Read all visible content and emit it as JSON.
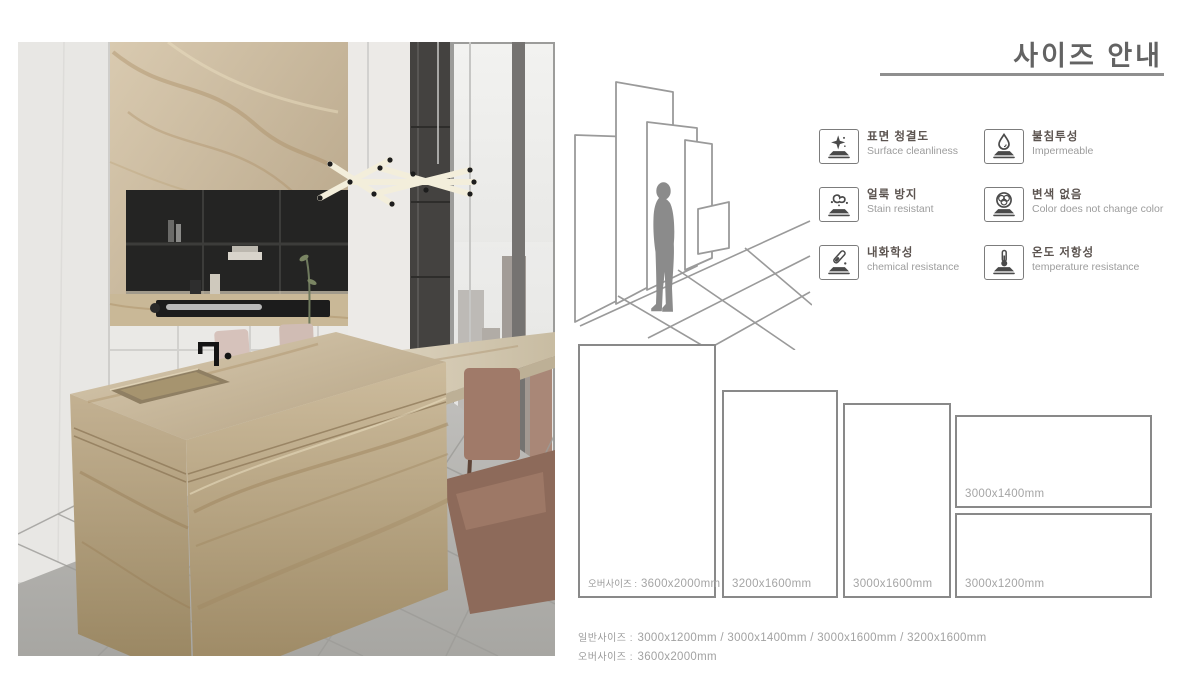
{
  "page": {
    "title": "사이즈 안내"
  },
  "features": [
    {
      "icon": "sparkle-clean-surface-icon",
      "ko": "표면 청결도",
      "en": "Surface cleanliness"
    },
    {
      "icon": "water-drop-icon",
      "ko": "불침투성",
      "en": "Impermeable"
    },
    {
      "icon": "stain-splash-icon",
      "ko": "얼룩 방지",
      "en": "Stain resistant"
    },
    {
      "icon": "color-circles-icon",
      "ko": "변색 없음",
      "en": "Color does not change color"
    },
    {
      "icon": "test-tube-icon",
      "ko": "내화학성",
      "en": "chemical resistance"
    },
    {
      "icon": "thermometer-icon",
      "ko": "온도 저항성",
      "en": "temperature resistance"
    }
  ],
  "slabs": [
    {
      "prefix": "오버사이즈 :",
      "size": "3600x2000mm"
    },
    {
      "size": "3200x1600mm"
    },
    {
      "size": "3000x1600mm"
    },
    {
      "size": "3000x1400mm"
    },
    {
      "size": "3000x1200mm"
    }
  ],
  "summary": [
    {
      "label": "일반사이즈 :",
      "value": "3000x1200mm / 3000x1400mm / 3000x1600mm / 3200x1600mm"
    },
    {
      "label": "오버사이즈 :",
      "value": "3600x2000mm"
    }
  ],
  "colors": {
    "title_gray": "#636363",
    "rule_gray": "#8f8f8f",
    "slab_border_gray": "#898989",
    "label_gray": "#a5a5a5",
    "diagram_line_gray": "#9a9a9a",
    "marble_tan": "#bfae8f"
  }
}
